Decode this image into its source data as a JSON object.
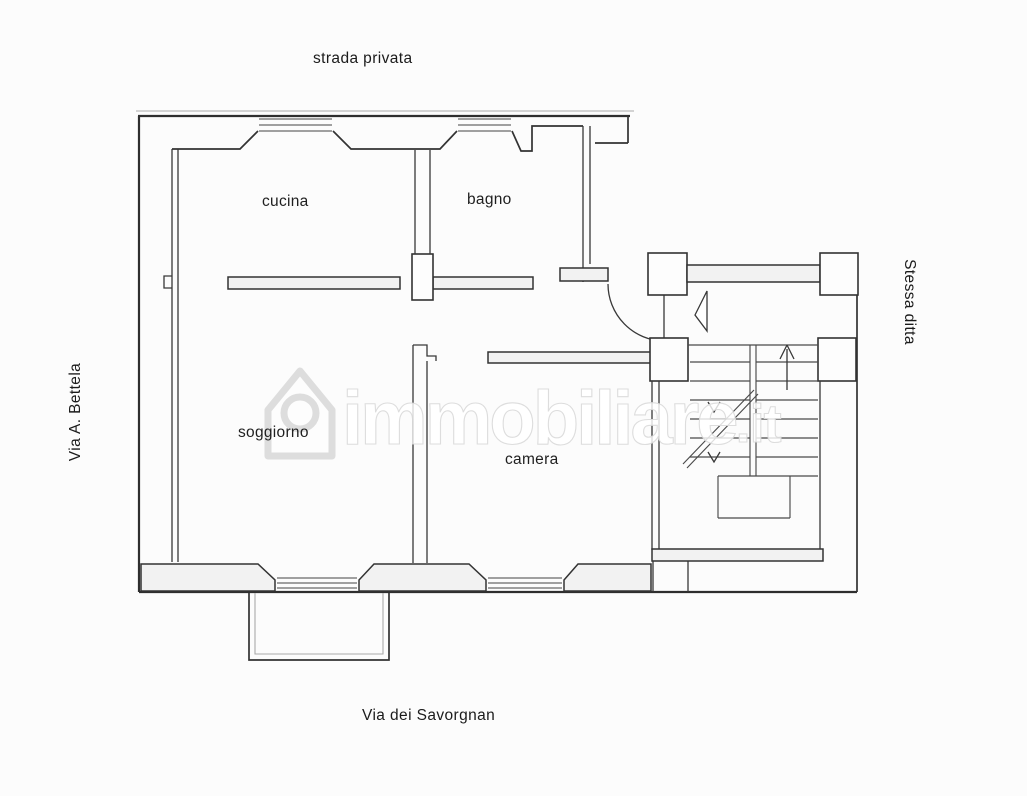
{
  "page": {
    "background": "#fcfcfc",
    "ink": "#2e2e2e",
    "wall_fill": "#f2f2f2",
    "scan_gray": "#aaaaaa",
    "watermark_tint": "#dcdcdc"
  },
  "streets": {
    "top": "strada privata",
    "left": "Via A. Bettela",
    "right": "Stessa ditta",
    "bottom": "Via dei Savorgnan"
  },
  "rooms": {
    "kitchen": "cucina",
    "bathroom": "bagno",
    "living_room": "soggiorno",
    "bedroom": "camera"
  },
  "watermark": {
    "brand": "immobiliare",
    "suffix": ".it"
  }
}
